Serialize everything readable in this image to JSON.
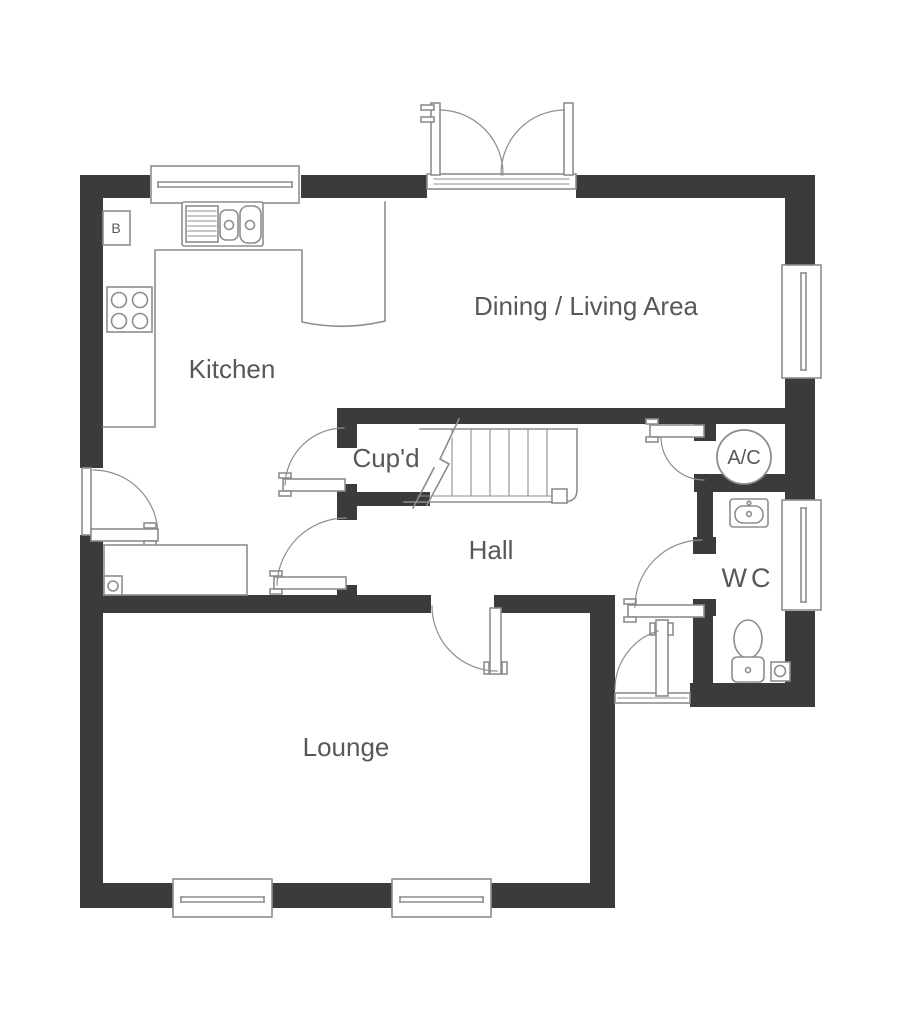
{
  "rooms": {
    "kitchen": "Kitchen",
    "dining_living": "Dining / Living Area",
    "cupboard": "Cup'd",
    "hall": "Hall",
    "ac": "A/C",
    "wc": "WC",
    "lounge": "Lounge",
    "boiler": "B"
  },
  "colors": {
    "wall": "#3b3a3c",
    "line": "#8d8d8f",
    "text": "#58585a",
    "background": "#ffffff"
  }
}
